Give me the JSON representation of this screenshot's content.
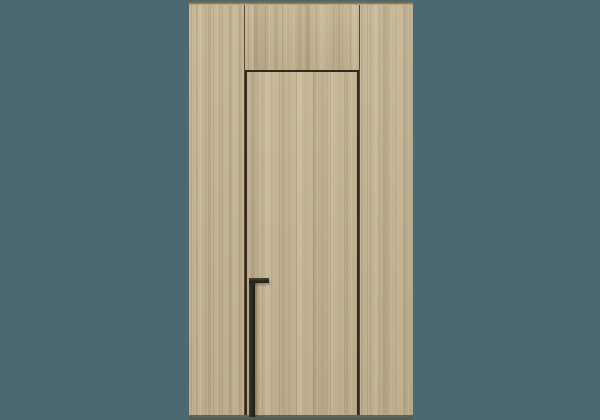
{
  "image": {
    "subject": "flush concealed wooden door with full-height black pull handle, set in matching vertical-grain wood wall paneling",
    "style": "3d product render on plain slate-teal backdrop",
    "text_content": "none"
  },
  "colors": {
    "background": "#4c6971",
    "wood_base": "#c4b494",
    "wood_grain_dark": "#ab9a78",
    "wood_grain_light": "#d2c3a3",
    "panel_top_edge": "#7c6f52",
    "seam": "#56442c",
    "door_gap": "#342a1c",
    "handle": "#2c2a25",
    "floor_shadow": "#615a46"
  },
  "components": {
    "wall_panels": [
      "left-stile",
      "transom-above-door",
      "door-leaf",
      "right-stile"
    ],
    "handle_shape": "inverted-L vertical pull bar reaching bottom edge"
  }
}
